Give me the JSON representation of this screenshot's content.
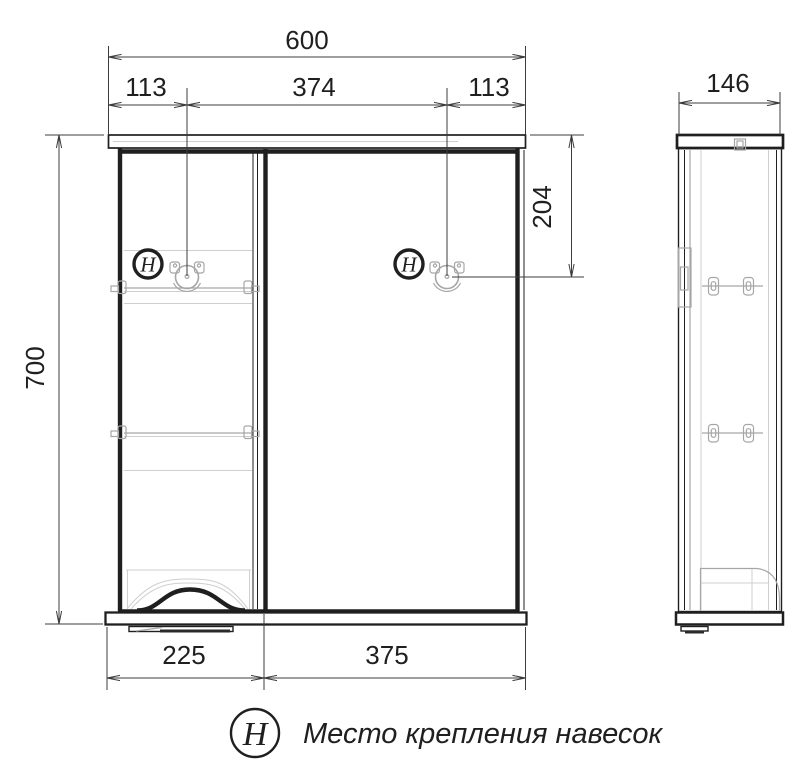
{
  "drawing_type": "cabinet-assembly-technical-drawing",
  "dimensions": {
    "front": {
      "total_width": "600",
      "hanger_left_offset": "113",
      "hanger_spacing": "374",
      "hanger_right_offset": "113",
      "height": "700",
      "hanger_top_offset": "204",
      "left_section_width": "225",
      "door_width": "375"
    },
    "side": {
      "depth": "146"
    }
  },
  "symbols": {
    "hanger_mark": "H"
  },
  "legend": {
    "symbol": "H",
    "label": "Место крепления навесок"
  },
  "colors": {
    "line": "#1f1f1f",
    "dim": "#3c3c3c",
    "hardware": "#a6a6a6",
    "faint": "#cfcfcf",
    "background": "#ffffff"
  }
}
